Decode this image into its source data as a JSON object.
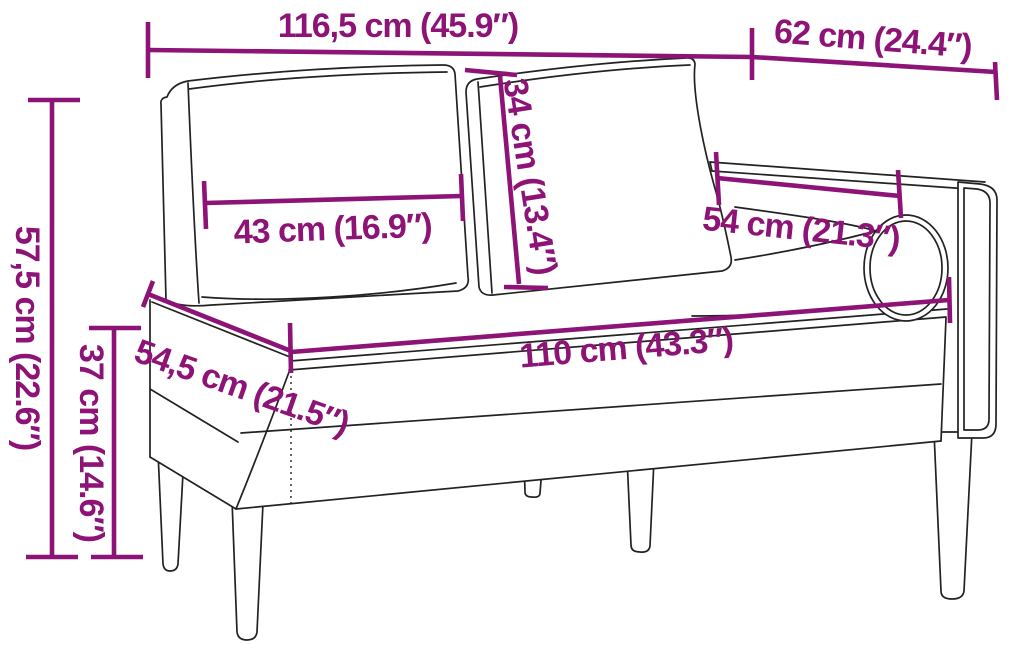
{
  "diagram": {
    "type": "product-dimension-diagram",
    "subject": "chaise-lounge-with-cushions-and-bolster",
    "colors": {
      "accent": "#8d1376",
      "line": "#222222",
      "background": "#ffffff"
    },
    "labels": {
      "total_width": "116,5 cm (45.9″)",
      "right_section_width": "62 cm (24.4″)",
      "total_height": "57,5 cm (22.6″)",
      "seat_height": "37 cm (14.6″)",
      "cushion_width": "43 cm (16.9″)",
      "cushion_height": "34 cm (13.4″)",
      "armrest_length": "54 cm (21.3″)",
      "seat_depth": "54,5 cm (21.5″)",
      "seat_length": "110 cm (43.3″)"
    }
  }
}
